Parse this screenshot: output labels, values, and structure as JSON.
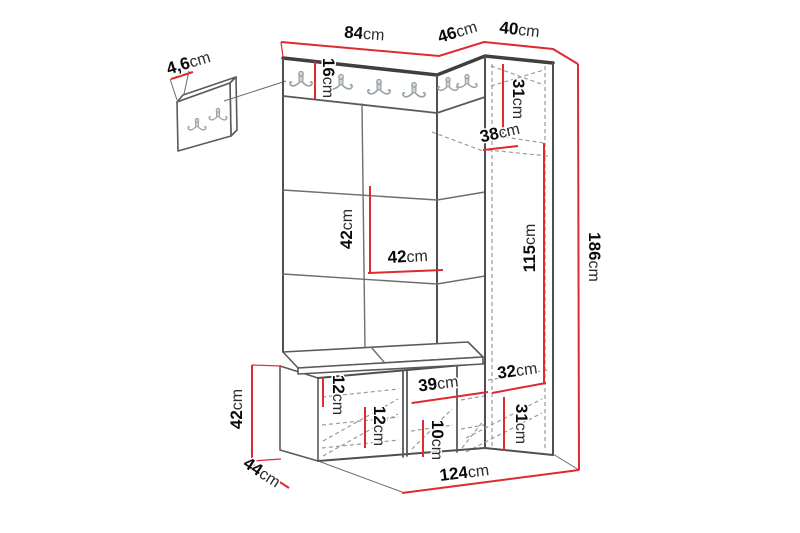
{
  "diagram": {
    "title": "Hallway furniture set dimension diagram",
    "units": "cm",
    "colors": {
      "dimension_line": "#de2a31",
      "outline": "#4f4f4f",
      "hidden_line": "#9b9b9b",
      "hook": "#98a1a6",
      "background": "#ffffff"
    },
    "dims": {
      "wall_panel_thickness": {
        "v": "4,6",
        "u": "cm"
      },
      "width_main_panel": {
        "v": "84",
        "u": "cm"
      },
      "width_corner": {
        "v": "46",
        "u": "cm"
      },
      "width_cabinet": {
        "v": "40",
        "u": "cm"
      },
      "hook_rail_height": {
        "v": "16",
        "u": "cm"
      },
      "cabinet_top_height": {
        "v": "31",
        "u": "cm"
      },
      "corner_depth": {
        "v": "38",
        "u": "cm"
      },
      "panel_tile_height": {
        "v": "42",
        "u": "cm"
      },
      "panel_tile_width": {
        "v": "42",
        "u": "cm"
      },
      "cabinet_door_height": {
        "v": "115",
        "u": "cm"
      },
      "total_height": {
        "v": "186",
        "u": "cm"
      },
      "cabinet_shelf_height": {
        "v": "32",
        "u": "cm"
      },
      "cabinet_bottom_height": {
        "v": "31",
        "u": "cm"
      },
      "bench_height": {
        "v": "42",
        "u": "cm"
      },
      "bench_depth": {
        "v": "44",
        "u": "cm"
      },
      "bench_shelf_top": {
        "v": "12",
        "u": "cm"
      },
      "bench_shelf_mid": {
        "v": "12",
        "u": "cm"
      },
      "bench_compartment_width": {
        "v": "39",
        "u": "cm"
      },
      "bench_shelf_bottom": {
        "v": "10",
        "u": "cm"
      },
      "total_width": {
        "v": "124",
        "u": "cm"
      }
    }
  }
}
